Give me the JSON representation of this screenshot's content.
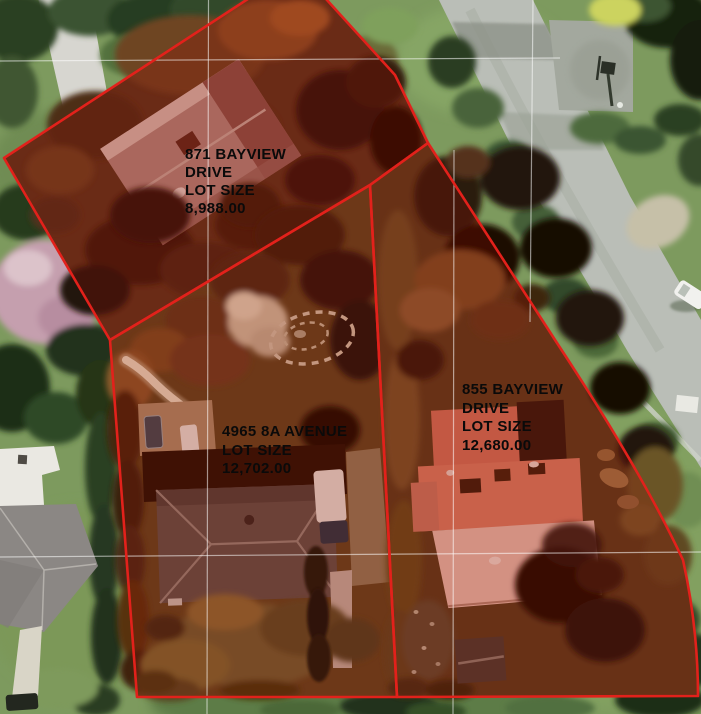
{
  "title": "Aerial parcel map",
  "map": {
    "description": "Aerial photograph with three highlighted property parcels outlined in red",
    "boundary_color": "#e2211b",
    "parcel_highlight_color": "rgba(150,12,4,0.27)",
    "cadastral_line_color": "#ffffff",
    "label_text_color": "#0a0a0a"
  },
  "parcels": [
    {
      "id": "871-bayview-drive",
      "address": "871 BAYVIEW DRIVE",
      "lot_size": "8,988.00",
      "lines": [
        "871 BAYVIEW",
        "DRIVE",
        "LOT SIZE",
        "8,988.00"
      ]
    },
    {
      "id": "4965-8a-avenue",
      "address": "4965 8A AVENUE",
      "lot_size": "12,702.00",
      "lines": [
        "4965 8A AVENUE",
        "LOT SIZE",
        "12,702.00"
      ]
    },
    {
      "id": "855-bayview-drive",
      "address": "855 BAYVIEW DRIVE",
      "lot_size": "12,680.00",
      "lines": [
        "855 BAYVIEW",
        "DRIVE",
        "LOT SIZE",
        "12,680.00"
      ]
    }
  ]
}
